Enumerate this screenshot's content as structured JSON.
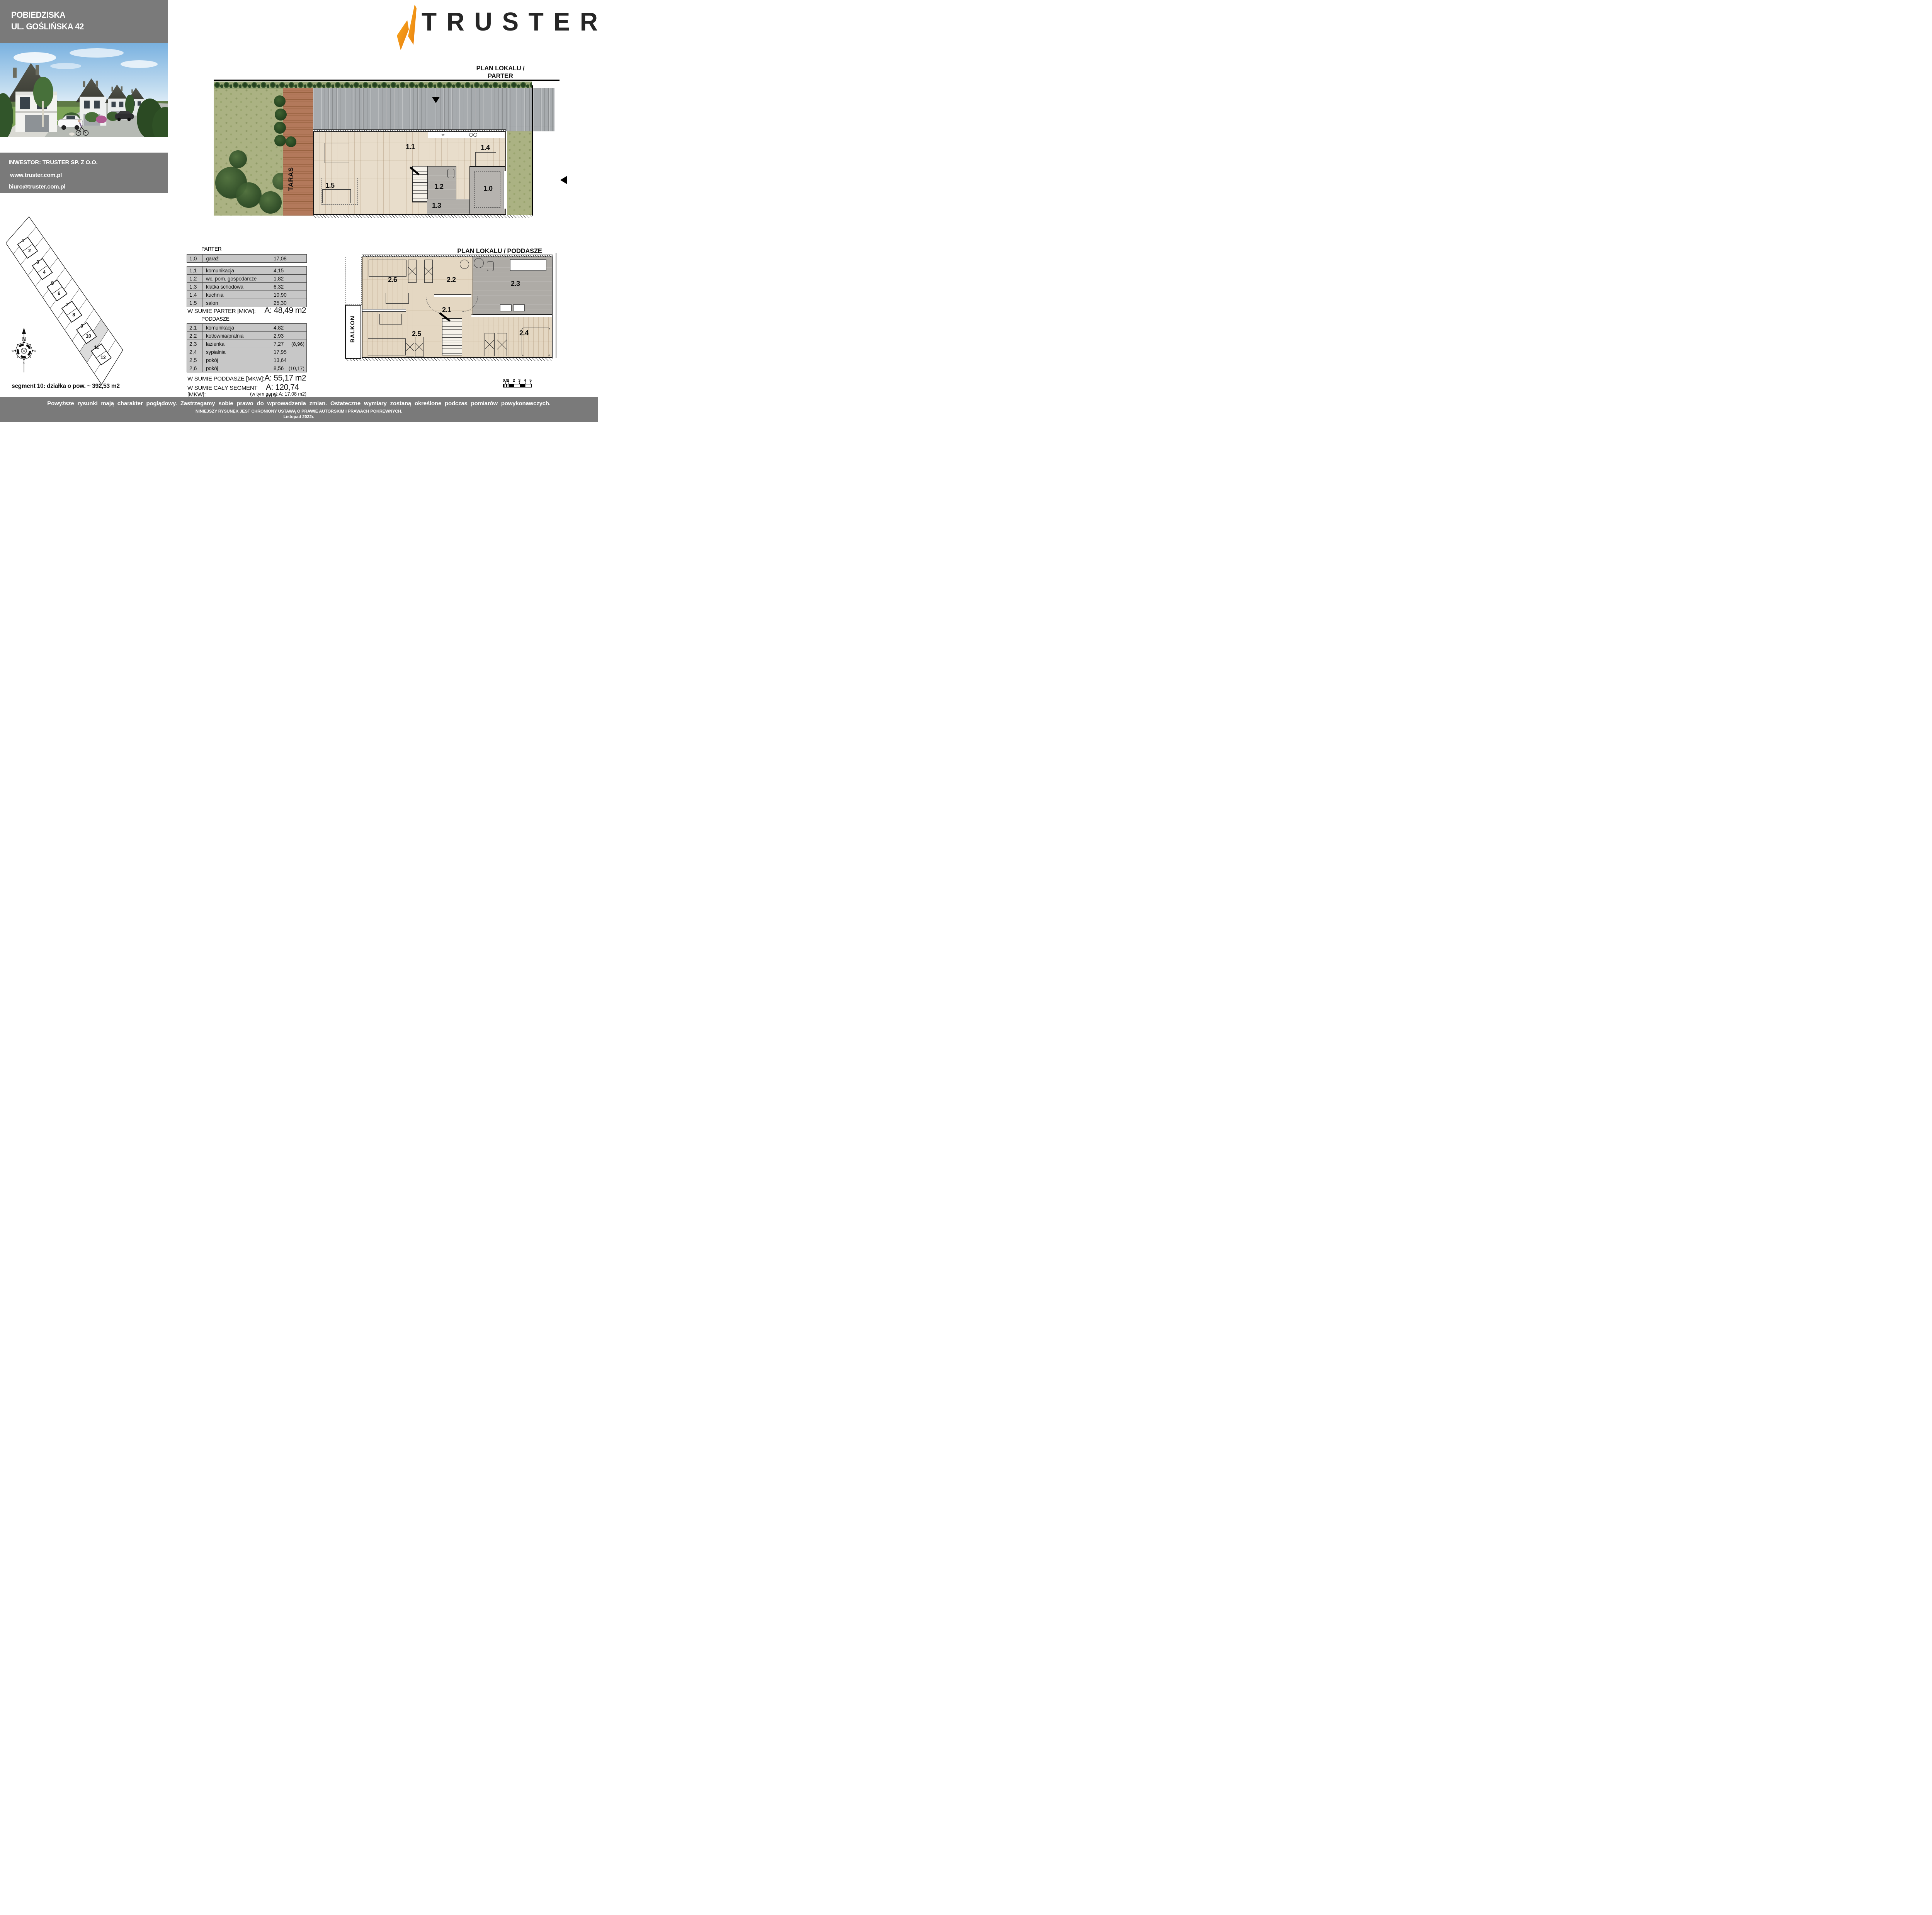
{
  "header": {
    "line1": "POBIEDZISKA",
    "line2": "UL. GOŚLIŃSKA 42"
  },
  "investor": {
    "line1": "INWESTOR:  TRUSTER SP. Z O.O.",
    "website": "www.truster.com.pl",
    "email": "biuro@truster.com.pl"
  },
  "logo": {
    "brand": "TRUSTER"
  },
  "plans": {
    "parter_title": "PLAN LOKALU / PARTER",
    "poddasze_title": "PLAN LOKALU / PODDASZE",
    "parter_labels": {
      "r10": "1.0",
      "r11": "1.1",
      "r12": "1.2",
      "r13": "1.3",
      "r14": "1.4",
      "r15": "1.5",
      "taras": "TARAS"
    },
    "poddasze_labels": {
      "r21": "2.1",
      "r22": "2.2",
      "r23": "2.3",
      "r24": "2.4",
      "r25": "2.5",
      "r26": "2.6",
      "balkon": "BALKON"
    }
  },
  "site_plan": {
    "plot_numbers": [
      "1",
      "2",
      "3",
      "4",
      "5",
      "6",
      "7",
      "8",
      "9",
      "10",
      "11",
      "12"
    ],
    "compass": {
      "n": "N",
      "w": "W",
      "e": "E",
      "s": "S"
    },
    "segment_note": "segment 10: działka o pow. ~ 392,53 m2"
  },
  "tables": {
    "parter_title": "PARTER",
    "garage_rows": [
      {
        "id": "1,0",
        "label": "garaż",
        "value": "17,08",
        "extra": ""
      }
    ],
    "parter_rows": [
      {
        "id": "1,1",
        "label": "komunikacja",
        "value": "4,15",
        "extra": ""
      },
      {
        "id": "1,2",
        "label": "wc, pom. gospodarcze",
        "value": "1,82",
        "extra": ""
      },
      {
        "id": "1,3",
        "label": "klatka schodowa",
        "value": "6,32",
        "extra": ""
      },
      {
        "id": "1,4",
        "label": "kuchnia",
        "value": "10,90",
        "extra": ""
      },
      {
        "id": "1,5",
        "label": "salon",
        "value": "25,30",
        "extra": ""
      }
    ],
    "parter_sum_label": "W SUMIE PARTER [MKW]:",
    "parter_sum_value": "A: 48,49 m2",
    "poddasze_title": "PODDASZE",
    "poddasze_rows": [
      {
        "id": "2,1",
        "label": "komunikacja",
        "value": "4,82",
        "extra": ""
      },
      {
        "id": "2,2",
        "label": "kotłownia/pralnia",
        "value": "2,93",
        "extra": ""
      },
      {
        "id": "2,3",
        "label": "łazienka",
        "value": "7,27",
        "extra": "(8,96)"
      },
      {
        "id": "2,4",
        "label": "sypialnia",
        "value": "17,95",
        "extra": ""
      },
      {
        "id": "2,5",
        "label": "pokój",
        "value": "13,64",
        "extra": ""
      },
      {
        "id": "2,6",
        "label": "pokój",
        "value": "8,56",
        "extra": "(10,17)"
      }
    ],
    "poddasze_sum_label": "W SUMIE PODDASZE [MKW]:",
    "poddasze_sum_value": "A: 55,17 m2",
    "total_label": "W SUMIE CAŁY SEGMENT [MKW]:",
    "total_value": "A: 120,74 m2",
    "total_note": "(w tym garaż A: 17,08 m2)"
  },
  "scale_bar": {
    "labels": [
      "0,5",
      "1",
      "2",
      "3",
      "4",
      "5"
    ]
  },
  "footer": {
    "line1": "Powyższe rysunki mają charakter poglądowy. Zastrzegamy sobie prawo do wprowadzenia zmian. Ostateczne wymiary zostaną określone podczas pomiarów powykonawczych.",
    "line2": "NINIEJSZY RYSUNEK JEST CHRONIONY USTAWĄ O PRAWIE AUTORSKIM I PRAWACH POKREWNYCH.",
    "line3": "Listopad 2022r."
  },
  "colors": {
    "panel_gray": "#7a7a7a",
    "table_cell_gray": "#c7c7c7",
    "accent_orange": "#f28c13",
    "brand_dark": "#262626",
    "plot10_fill": "#dcdcdc"
  }
}
